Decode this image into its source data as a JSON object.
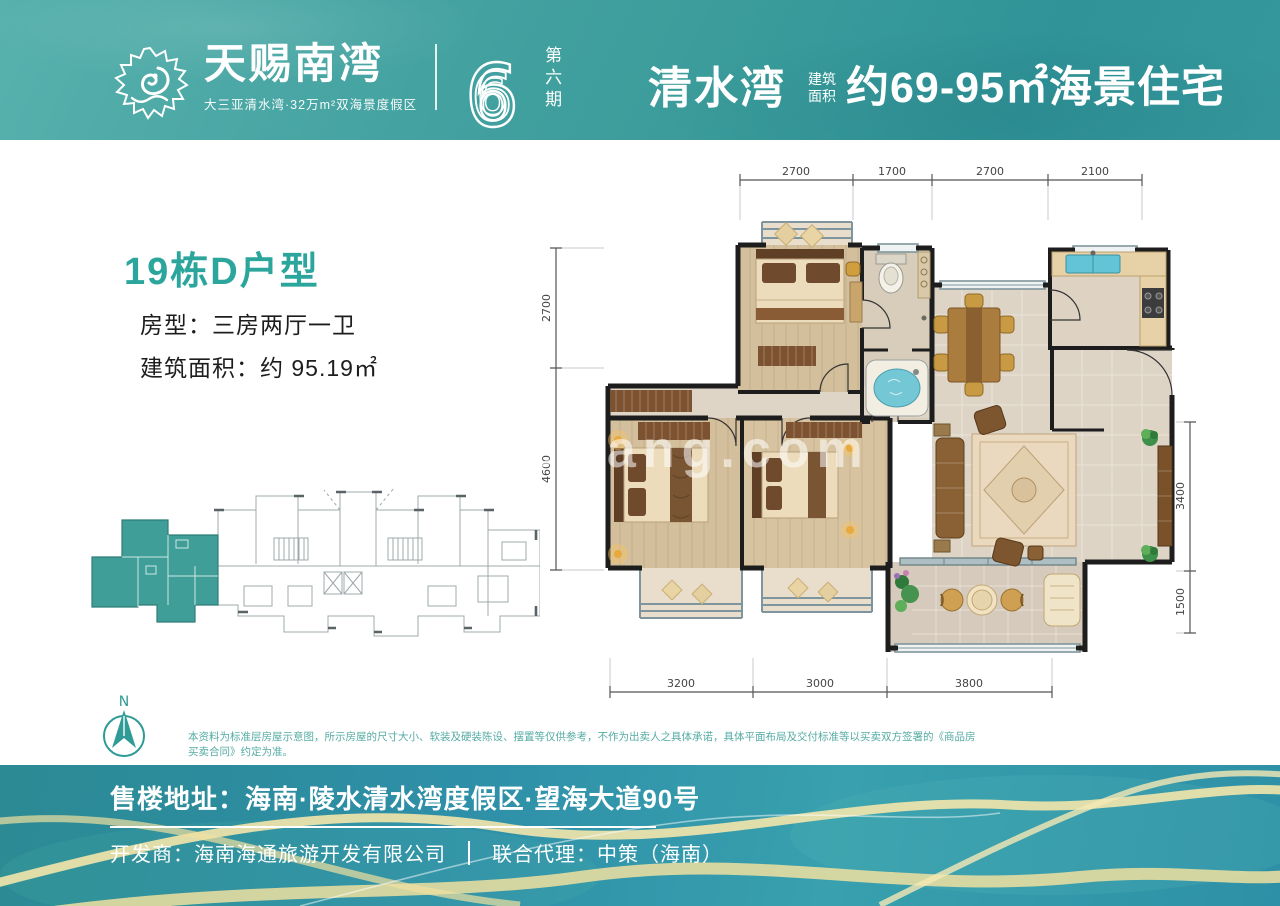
{
  "header": {
    "brand": {
      "title": "天赐南湾",
      "tagline": "大三亚清水湾·32万m²双海景度假区",
      "phase_number": "6",
      "phase_label": "第六期"
    },
    "headline": {
      "location": "清水湾",
      "area_label_1": "建筑",
      "area_label_2": "面积",
      "text": "约69-95㎡海景住宅"
    }
  },
  "unit": {
    "title": "19栋D户型",
    "layout": "房型：三房两厅一卫",
    "area": "建筑面积：约 95.19㎡"
  },
  "plan": {
    "dims_top": [
      "2700",
      "1700",
      "2700",
      "2100"
    ],
    "dims_left": [
      "2700",
      "4600"
    ],
    "dims_right": [
      "3400",
      "1500"
    ],
    "dims_bottom": [
      "3200",
      "3000",
      "3800"
    ],
    "north_label": "N",
    "watermark": "meifang.com"
  },
  "disclaimer": {
    "text": "本资料为标准层房屋示意图，所示房屋的尺寸大小、软装及硬装陈设、摆置等仅供参考，不作为出卖人之具体承诺，具体平面布局及交付标准等以买卖双方签署的《商品房买卖合同》约定为准。"
  },
  "footer": {
    "address": "售楼地址：海南·陵水清水湾度假区·望海大道90号",
    "developer": "开发商：海南海通旅游开发有限公司",
    "agent": "联合代理：中策（海南）"
  },
  "colors": {
    "header_teal": "#3b9c9b",
    "accent_teal": "#2ca69d",
    "keyplan_highlight": "#3f9e98",
    "footer_blue": "#2e8fa8",
    "wave_gold": "#f3e5ab",
    "wall_dark": "#1d1d1d",
    "wood_floor": "#d3bf9b",
    "tile_floor": "#ddd4c5"
  }
}
